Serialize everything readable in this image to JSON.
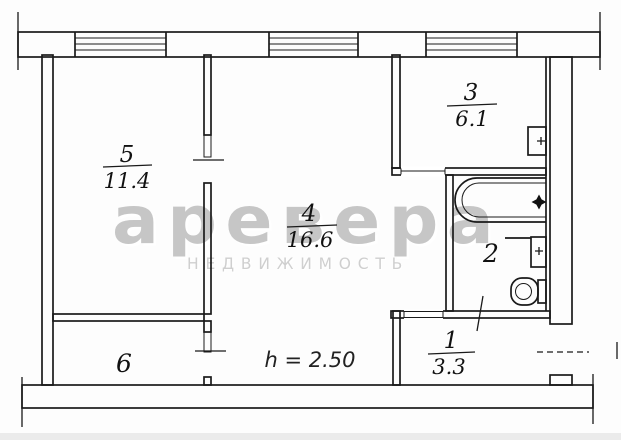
{
  "plan": {
    "ceiling_height": "h = 2.50",
    "rooms": [
      {
        "number": "5",
        "area": "11.4"
      },
      {
        "number": "4",
        "area": "16.6"
      },
      {
        "number": "3",
        "area": "6.1"
      },
      {
        "number": "2"
      },
      {
        "number": "6"
      },
      {
        "number": "1",
        "area": "3.3"
      }
    ]
  },
  "watermark": {
    "brand": "аревера",
    "subtitle": "НЕДВИЖИМОСТЬ"
  },
  "colors": {
    "ink": "#1a1a1a",
    "watermark_gray": "#c6c6c6"
  },
  "symbols": [
    "bathtub-icon",
    "toilet-icon",
    "sink-box-icon",
    "vent-box-icon",
    "four-point-star-icon",
    "window-hatch",
    "entrance-door-dash"
  ]
}
